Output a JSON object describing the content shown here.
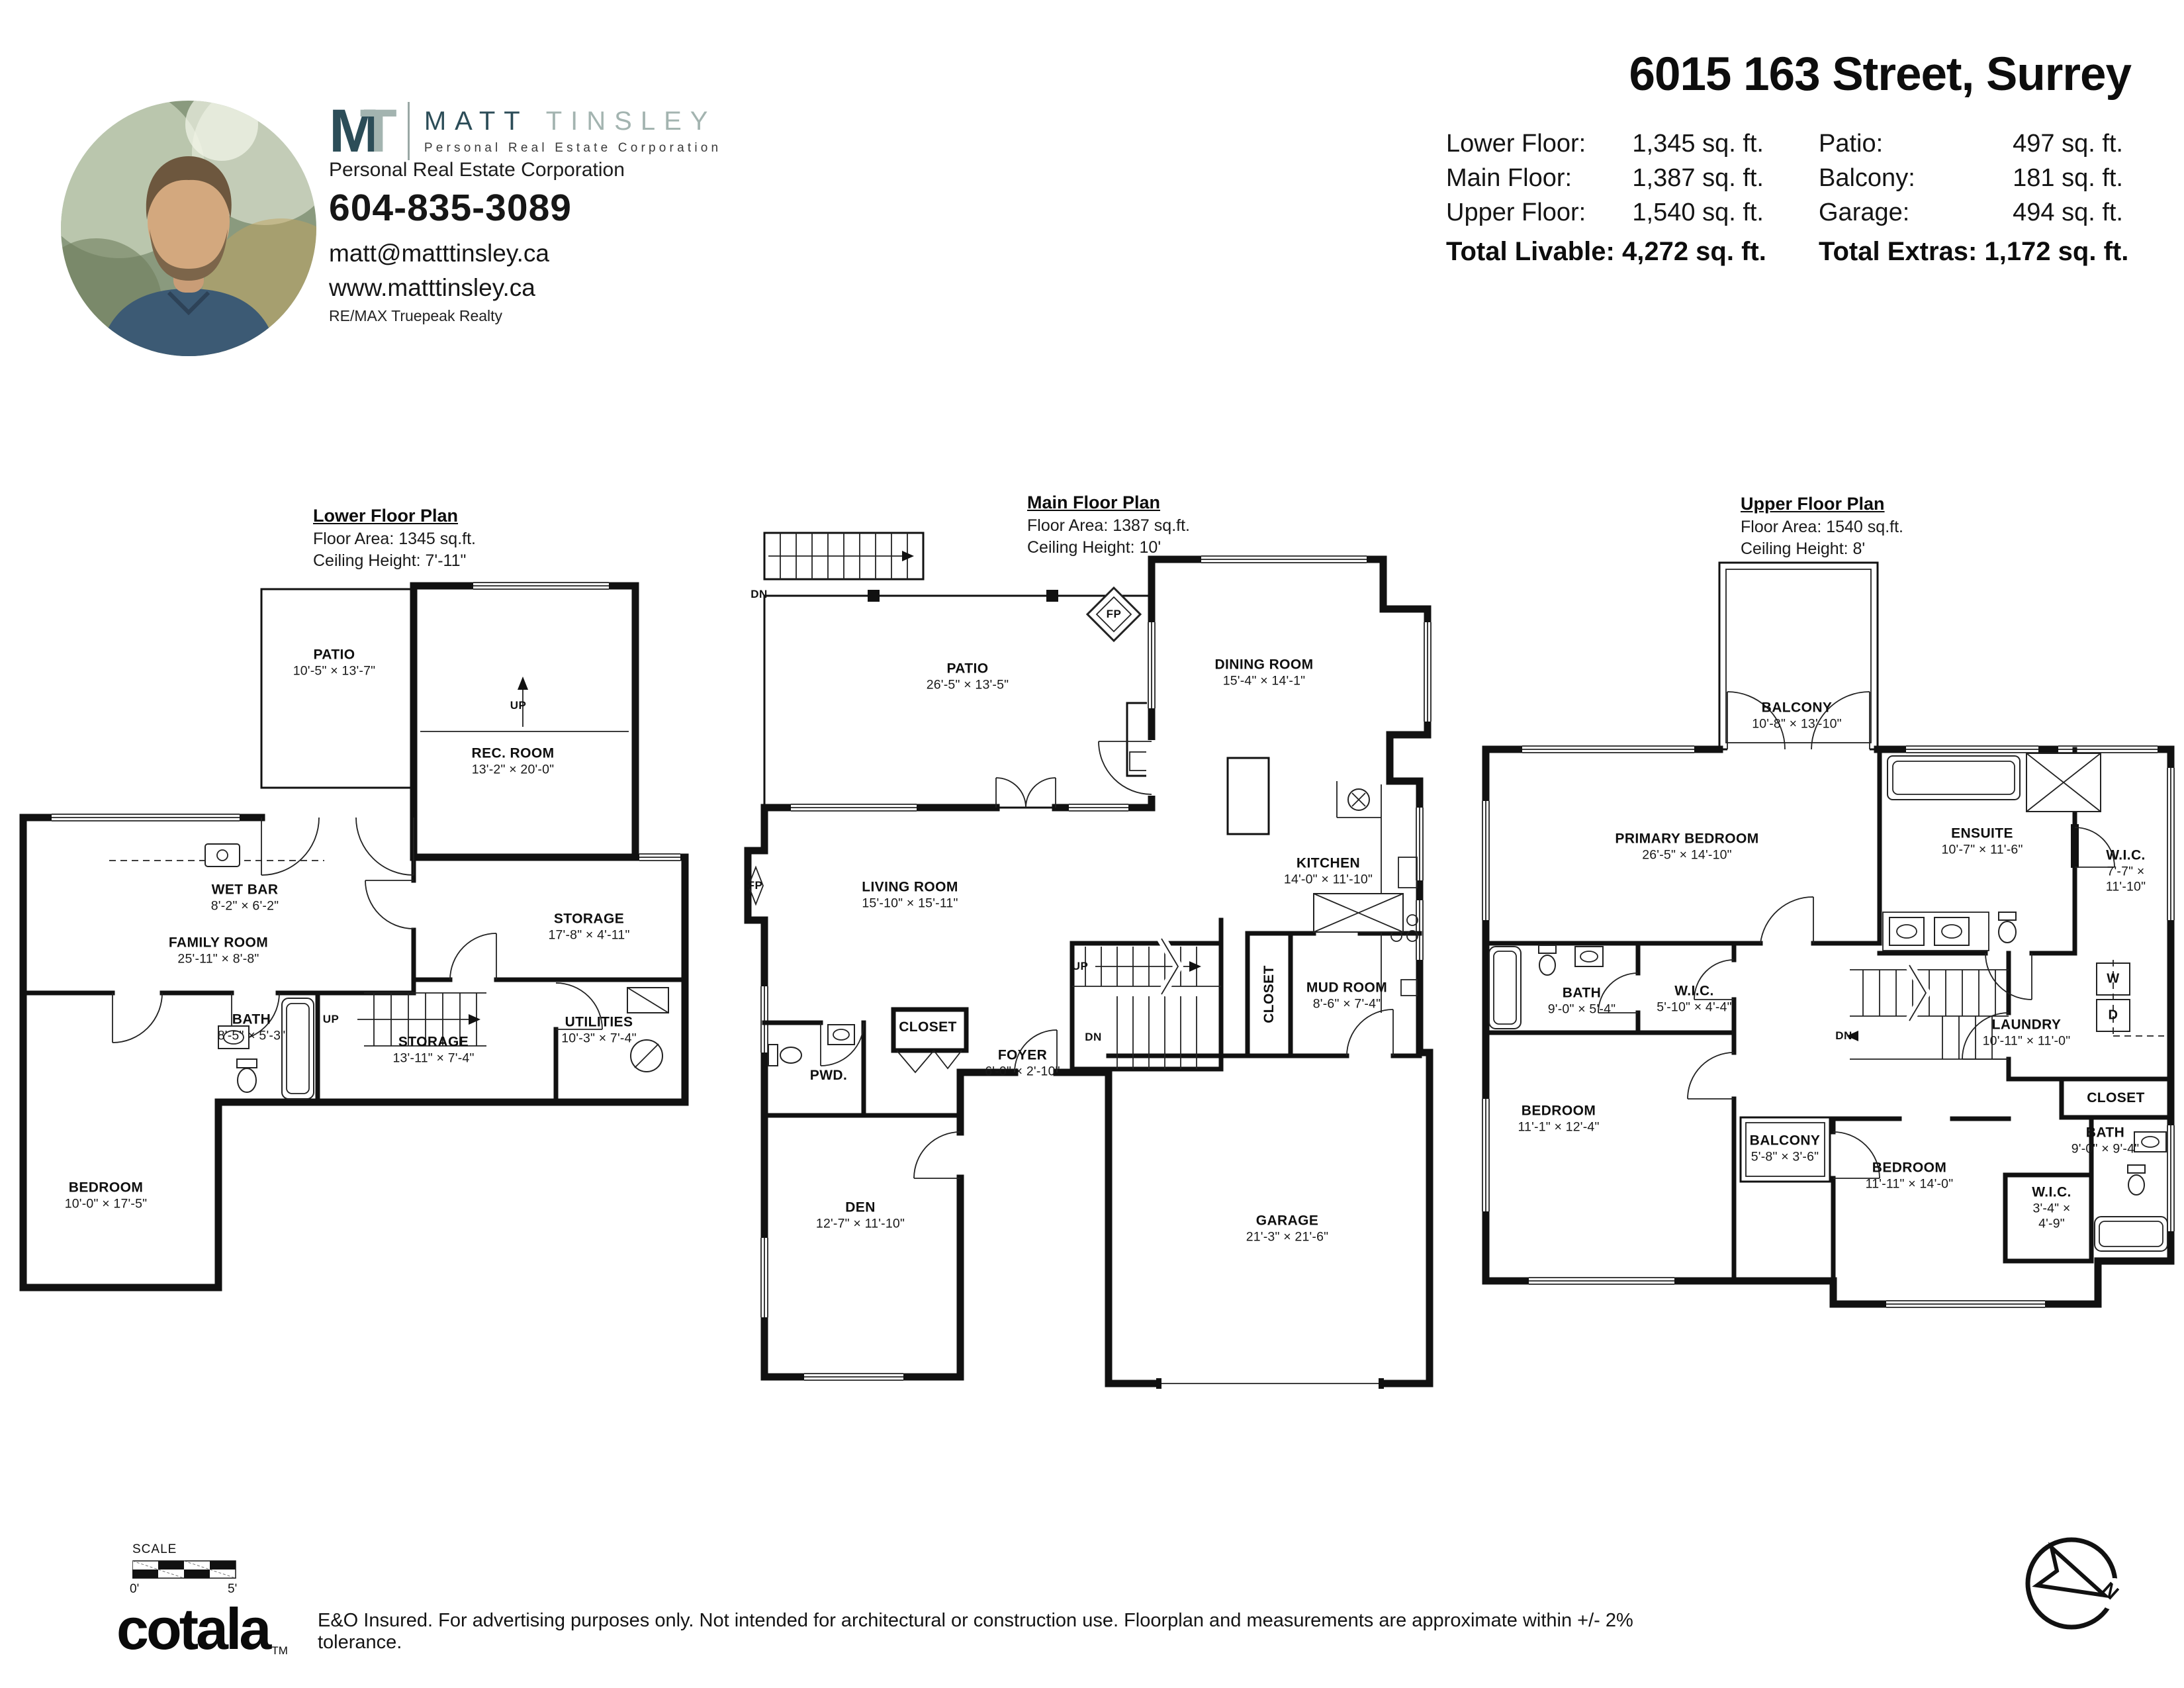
{
  "colors": {
    "brand_teal": "#2c4d58",
    "brand_gray": "#a3b4b0",
    "ink": "#111111"
  },
  "header": {
    "agent": {
      "logo_m": "M",
      "logo_t": "T",
      "logo_first": "MATT",
      "logo_last": "TINSLEY",
      "logo_subtitle": "Personal Real Estate Corporation",
      "designation": "Personal Real Estate Corporation",
      "phone": "604-835-3089",
      "email": "matt@matttinsley.ca",
      "website": "www.matttinsley.ca",
      "brokerage": "RE/MAX Truepeak Realty",
      "photo_alt": "agent-photo"
    },
    "property": {
      "title": "6015 163 Street, Surrey",
      "stats_left": [
        {
          "label": "Lower Floor:",
          "value": "1,345 sq. ft."
        },
        {
          "label": "Main Floor:",
          "value": "1,387 sq. ft."
        },
        {
          "label": "Upper Floor:",
          "value": "1,540 sq. ft."
        }
      ],
      "stats_right": [
        {
          "label": "Patio:",
          "value": "497 sq. ft."
        },
        {
          "label": "Balcony:",
          "value": "181 sq. ft."
        },
        {
          "label": "Garage:",
          "value": "494 sq. ft."
        }
      ],
      "total_livable": {
        "label": "Total Livable:",
        "value": "4,272 sq. ft."
      },
      "total_extras": {
        "label": "Total Extras:",
        "value": "1,172 sq. ft."
      }
    }
  },
  "plans": {
    "lower": {
      "title": "Lower Floor Plan",
      "area": "Floor Area: 1345 sq.ft.",
      "ceiling": "Ceiling Height: 7'-11\"",
      "rooms": [
        {
          "name": "PATIO",
          "dims": "10'-5\" × 13'-7\""
        },
        {
          "name": "REC. ROOM",
          "dims": "13'-2\" × 20'-0\""
        },
        {
          "name": "WET BAR",
          "dims": "8'-2\" × 6'-2\""
        },
        {
          "name": "FAMILY ROOM",
          "dims": "25'-11\" × 8'-8\""
        },
        {
          "name": "STORAGE",
          "dims": "17'-8\" × 4'-11\""
        },
        {
          "name": "BATH",
          "dims": "8'-5\" × 5'-3\""
        },
        {
          "name": "STORAGE",
          "dims": "13'-11\" × 7'-4\""
        },
        {
          "name": "UTILITIES",
          "dims": "10'-3\" × 7'-4\""
        },
        {
          "name": "BEDROOM",
          "dims": "10'-0\" × 17'-5\""
        }
      ],
      "ann": {
        "up_rec": "UP",
        "up_stairs": "UP"
      }
    },
    "main": {
      "title": "Main Floor Plan",
      "area": "Floor Area: 1387 sq.ft.",
      "ceiling": "Ceiling Height: 10'",
      "rooms": [
        {
          "name": "PATIO",
          "dims": "26'-5\" × 13'-5\""
        },
        {
          "name": "DINING ROOM",
          "dims": "15'-4\" × 14'-1\""
        },
        {
          "name": "LIVING ROOM",
          "dims": "15'-10\" × 15'-11\""
        },
        {
          "name": "KITCHEN",
          "dims": "14'-0\" × 11'-10\""
        },
        {
          "name": "MUD ROOM",
          "dims": "8'-6\" × 7'-4\""
        },
        {
          "name": "FOYER",
          "dims": "6'-0\" × 2'-10\""
        },
        {
          "name": "DEN",
          "dims": "12'-7\" × 11'-10\""
        },
        {
          "name": "GARAGE",
          "dims": "21'-3\" × 21'-6\""
        },
        {
          "name": "PWD.",
          "dims": ""
        },
        {
          "name": "CLOSET",
          "dims": ""
        },
        {
          "name": "CLOSET",
          "dims": ""
        }
      ],
      "ann": {
        "dn_ext": "DN",
        "fp_patio": "FP",
        "fp_living": "FP",
        "up": "UP",
        "dn": "DN"
      }
    },
    "upper": {
      "title": "Upper Floor Plan",
      "area": "Floor Area: 1540 sq.ft.",
      "ceiling": "Ceiling Height: 8'",
      "rooms": [
        {
          "name": "BALCONY",
          "dims": "10'-8\" × 13'-10\""
        },
        {
          "name": "PRIMARY BEDROOM",
          "dims": "26'-5\" × 14'-10\""
        },
        {
          "name": "ENSUITE",
          "dims": "10'-7\" × 11'-6\""
        },
        {
          "name": "W.I.C.",
          "dims": "7'-7\" × 11'-10\""
        },
        {
          "name": "BATH",
          "dims": "9'-0\" × 5'-4\""
        },
        {
          "name": "W.I.C.",
          "dims": "5'-10\" × 4'-4\""
        },
        {
          "name": "LAUNDRY",
          "dims": "10'-11\" × 11'-0\""
        },
        {
          "name": "BEDROOM",
          "dims": "11'-1\" × 12'-4\""
        },
        {
          "name": "BALCONY",
          "dims": "5'-8\" × 3'-6\""
        },
        {
          "name": "BEDROOM",
          "dims": "11'-11\" × 14'-0\""
        },
        {
          "name": "CLOSET",
          "dims": ""
        },
        {
          "name": "BATH",
          "dims": "9'-0\" × 9'-4\""
        },
        {
          "name": "W.I.C.",
          "dims": "3'-4\" × 4'-9\""
        }
      ],
      "ann": {
        "dn": "DN",
        "washer": "W",
        "dryer": "D"
      }
    }
  },
  "footer": {
    "scale_label": "SCALE",
    "scale_zero": "0'",
    "scale_five": "5'",
    "logo_text": "cotala",
    "logo_tm": "TM",
    "disclaimer": "E&O Insured. For advertising purposes only. Not intended for architectural or construction use. Floorplan and measurements are approximate within +/- 2% tolerance.",
    "compass_n": "N"
  }
}
